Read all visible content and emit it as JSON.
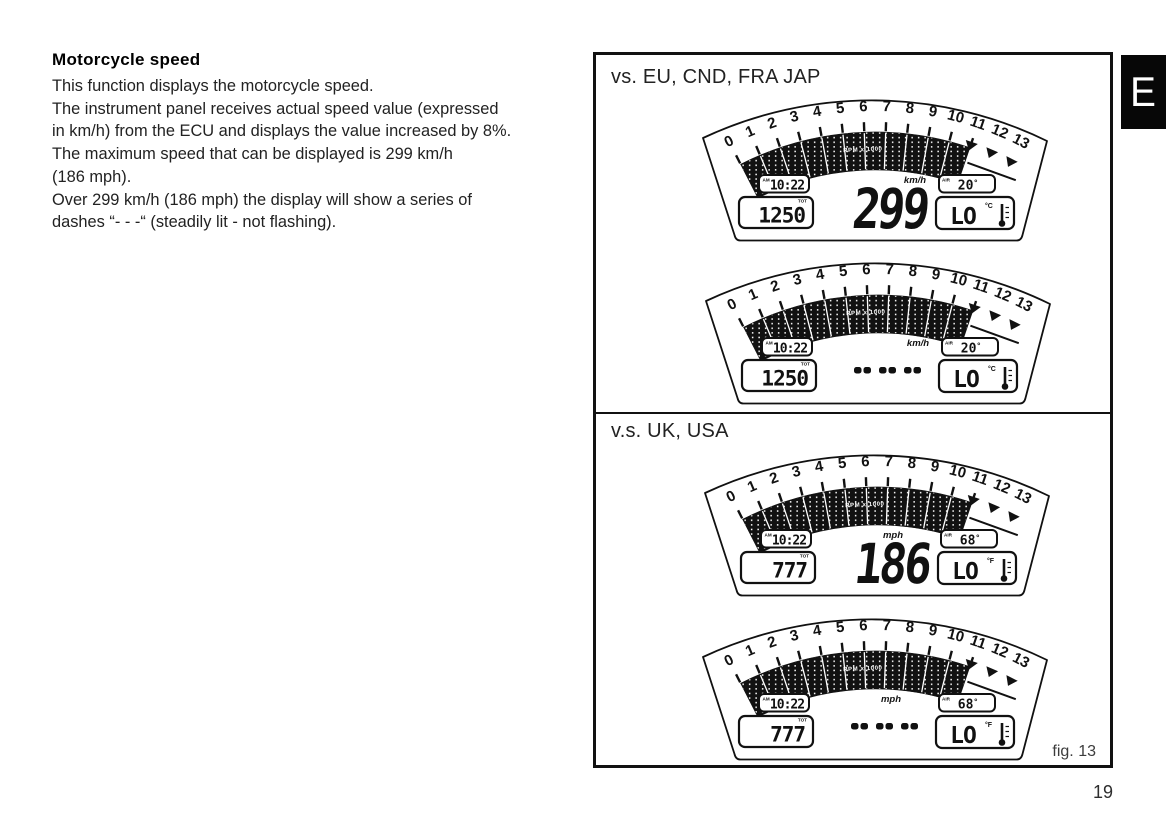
{
  "article": {
    "heading": "Motorcycle speed",
    "body": "This function displays the motorcycle speed.\nThe instrument panel receives actual speed value (expressed\nin km/h) from the ECU and displays the value increased by 8%.\nThe maximum speed that can be displayed is 299 km/h\n(186 mph).\nOver 299 km/h (186 mph) the display will show a series of\ndashes “- - -“ (steadily lit - not flashing)."
  },
  "sidebar_tab": {
    "label": "E"
  },
  "page_number": "19",
  "figure": {
    "caption": "fig. 13",
    "sections": [
      {
        "title": "vs. EU, CND, FRA JAP",
        "gauges": [
          {
            "tachometer": {
              "tick_labels": [
                "0",
                "1",
                "2",
                "3",
                "4",
                "5",
                "6",
                "7",
                "8",
                "9",
                "10",
                "11",
                "12",
                "13"
              ],
              "bars_filled_to": 11,
              "center_label": "RPM x 1000"
            },
            "clock": {
              "meridiem": "AM",
              "time": "10:22"
            },
            "odometer": {
              "label": "TOT",
              "value": "1250"
            },
            "speed": {
              "display": "299",
              "unit": "km/h"
            },
            "air_temp": {
              "label": "AIR",
              "value": "20",
              "suffix": "°"
            },
            "coolant_temp": {
              "value": "LO",
              "unit": "°C"
            }
          },
          {
            "tachometer": {
              "tick_labels": [
                "0",
                "1",
                "2",
                "3",
                "4",
                "5",
                "6",
                "7",
                "8",
                "9",
                "10",
                "11",
                "12",
                "13"
              ],
              "bars_filled_to": 11,
              "center_label": "RPM x 1000"
            },
            "clock": {
              "meridiem": "AM",
              "time": "10:22"
            },
            "odometer": {
              "label": "TOT",
              "value": "1250"
            },
            "speed": {
              "display": "---",
              "unit": "km/h"
            },
            "air_temp": {
              "label": "AIR",
              "value": "20",
              "suffix": "°"
            },
            "coolant_temp": {
              "value": "LO",
              "unit": "°C"
            }
          }
        ]
      },
      {
        "title": "v.s. UK, USA",
        "gauges": [
          {
            "tachometer": {
              "tick_labels": [
                "0",
                "1",
                "2",
                "3",
                "4",
                "5",
                "6",
                "7",
                "8",
                "9",
                "10",
                "11",
                "12",
                "13"
              ],
              "bars_filled_to": 11,
              "center_label": "RPM x 1000"
            },
            "clock": {
              "meridiem": "AM",
              "time": "10:22"
            },
            "odometer": {
              "label": "TOT",
              "value": "777"
            },
            "speed": {
              "display": "186",
              "unit": "mph"
            },
            "air_temp": {
              "label": "AIR",
              "value": "68",
              "suffix": "°"
            },
            "coolant_temp": {
              "value": "LO",
              "unit": "°F"
            }
          },
          {
            "tachometer": {
              "tick_labels": [
                "0",
                "1",
                "2",
                "3",
                "4",
                "5",
                "6",
                "7",
                "8",
                "9",
                "10",
                "11",
                "12",
                "13"
              ],
              "bars_filled_to": 11,
              "center_label": "RPM x 1000"
            },
            "clock": {
              "meridiem": "AM",
              "time": "10:22"
            },
            "odometer": {
              "label": "TOT",
              "value": "777"
            },
            "speed": {
              "display": "---",
              "unit": "mph"
            },
            "air_temp": {
              "label": "AIR",
              "value": "68",
              "suffix": "°"
            },
            "coolant_temp": {
              "value": "LO",
              "unit": "°F"
            }
          }
        ]
      }
    ]
  }
}
